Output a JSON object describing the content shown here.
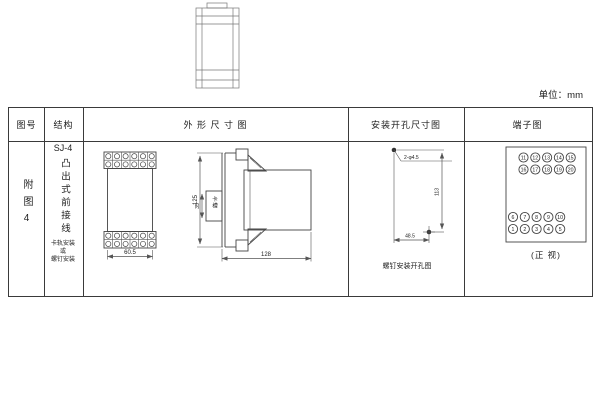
{
  "unit_label": "单位：mm",
  "table": {
    "header_fig_no": "图号",
    "header_structure": "结构",
    "header_outline": "外 形 尺 寸 图",
    "header_mounting": "安装开孔尺寸图",
    "header_terminal": "端子图"
  },
  "fig_no": "附图4",
  "structure": {
    "model": "SJ-4",
    "type_vertical": "凸出式前接线",
    "mount_note": "卡轨安装\n或\n螺钉安装"
  },
  "outline_dims": {
    "front_width": "60.5",
    "height": "125",
    "depth": "128",
    "rail_slot": "35",
    "rail_slot_label": "卡槽"
  },
  "mounting": {
    "hole_label": "2-φ4.5",
    "height_dim": "113",
    "width_dim": "48.5",
    "caption": "螺钉安装开孔图"
  },
  "terminals": {
    "caption": "(正 视)",
    "upper_rows": [
      [
        "11",
        "12",
        "13",
        "14",
        "15"
      ],
      [
        "16",
        "17",
        "18",
        "19",
        "20"
      ]
    ],
    "lower_rows": [
      [
        "6",
        "7",
        "8",
        "9",
        "10"
      ],
      [
        "1",
        "2",
        "3",
        "4",
        "5"
      ]
    ]
  }
}
